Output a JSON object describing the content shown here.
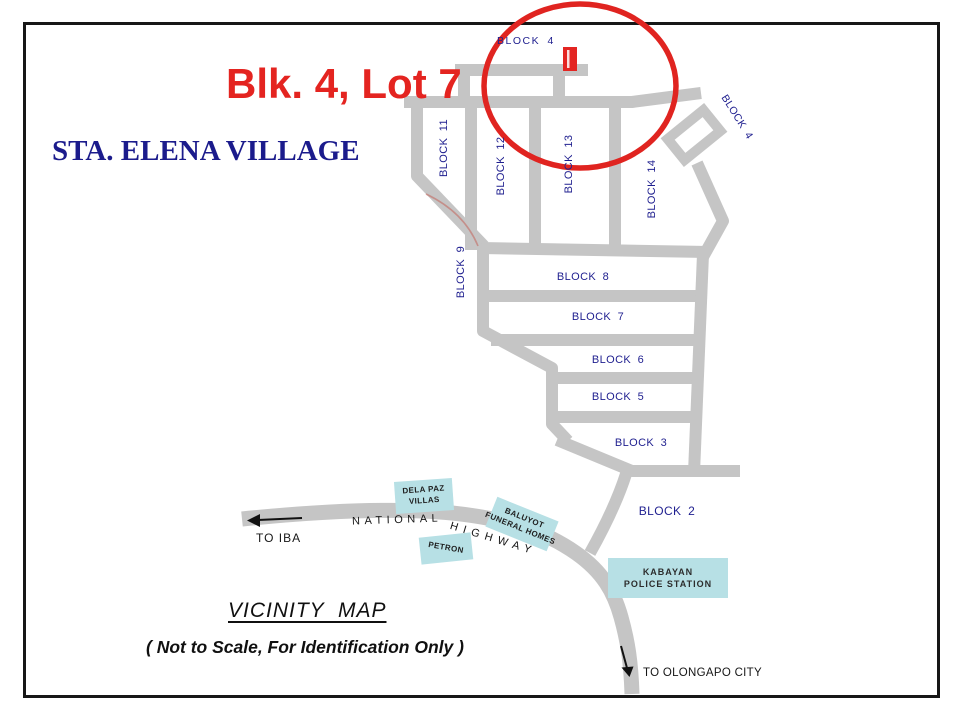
{
  "header": {
    "lot_title": "Blk. 4, Lot 7",
    "village_title": "STA. ELENA VILLAGE"
  },
  "map": {
    "block_labels": {
      "top_block4": "BLOCK 4",
      "side_block4": "BLOCK 4",
      "block11": "BLOCK 11",
      "block12": "BLOCK 12",
      "block13": "BLOCK 13",
      "block14": "BLOCK 14",
      "block9": "BLOCK 9",
      "block8": "BLOCK 8",
      "block7": "BLOCK 7",
      "block6": "BLOCK 6",
      "block5": "BLOCK 5",
      "block3": "BLOCK 3",
      "block2": "BLOCK 2"
    },
    "landmarks": {
      "dela_paz": {
        "line1": "DELA PAZ",
        "line2": "VILLAS"
      },
      "petron": {
        "label": "PETRON"
      },
      "baluyot": {
        "line1": "BALUYOT",
        "line2": "FUNERAL HOMES"
      },
      "kabayan": {
        "line1": "KABAYAN",
        "line2": "POLICE STATION"
      }
    },
    "road_labels": {
      "national": "NATIONAL",
      "highway": "HIGHWAY",
      "to_iba": "TO IBA",
      "to_olongapo": "TO OLONGAPO CITY"
    },
    "colors": {
      "road_gray": "#c5c5c5",
      "annotation_red": "#e02420",
      "label_navy": "#1f1f8f",
      "landmark_teal": "#b7e0e5"
    }
  },
  "footer": {
    "vicinity_title": "VICINITY  MAP",
    "vicinity_note": "( Not to Scale, For Identification Only )"
  }
}
